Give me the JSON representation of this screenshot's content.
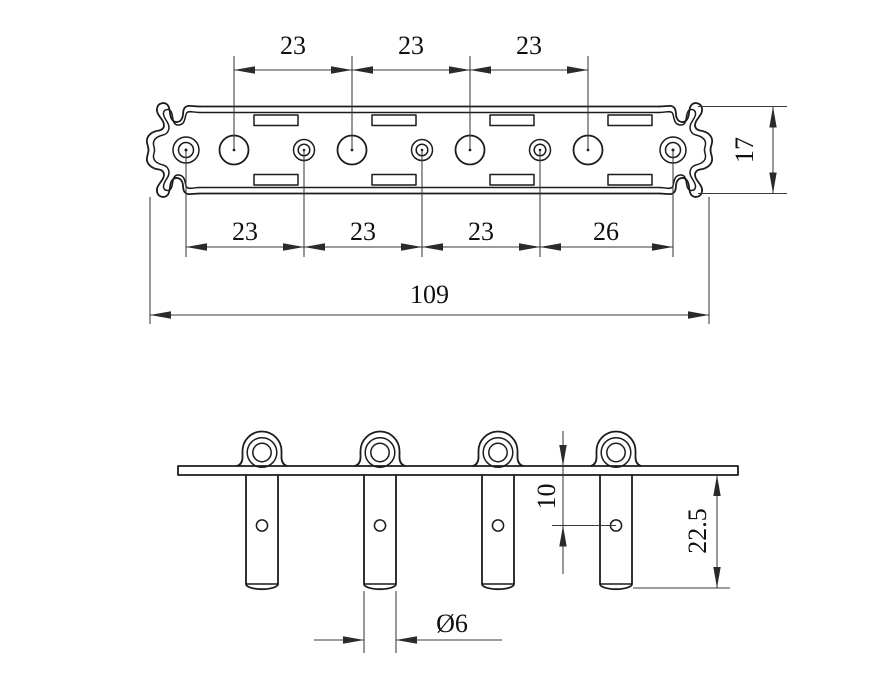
{
  "colors": {
    "background": "#ffffff",
    "object_line": "#1c1c1c",
    "dimension_line": "#3a3a3a",
    "text": "#101010"
  },
  "top_view": {
    "upper_spacing_dims": [
      "23",
      "23",
      "23"
    ],
    "lower_spacing_dims": [
      "23",
      "23",
      "23",
      "26"
    ],
    "overall_length_dim": "109",
    "height_dim": "17"
  },
  "side_view": {
    "hole_offset_dim": "10",
    "post_length_dim": "22.5",
    "post_diameter_dim": "Ø6"
  }
}
